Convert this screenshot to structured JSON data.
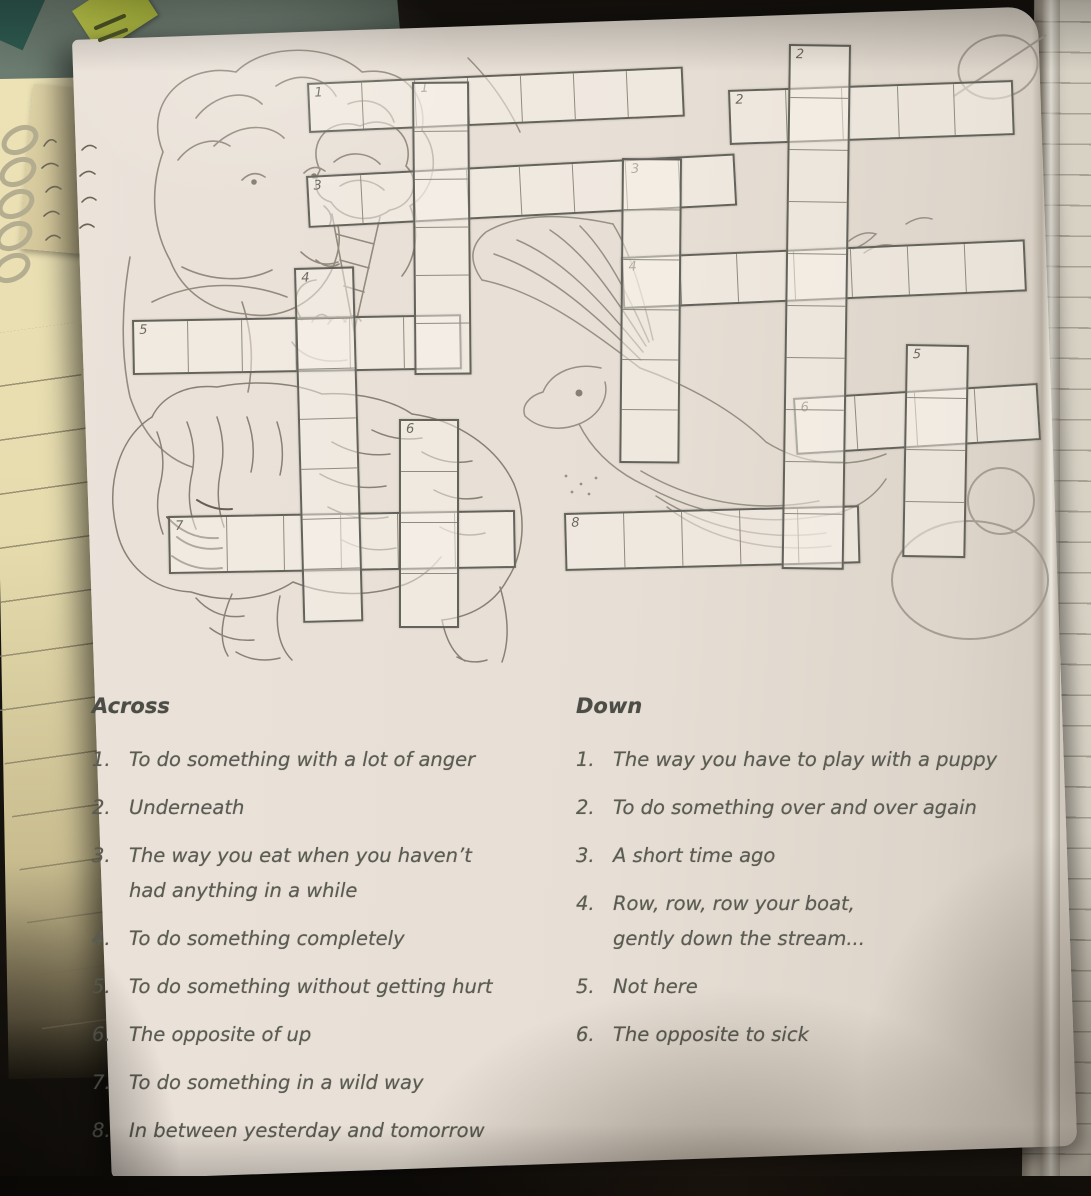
{
  "worksheet": {
    "across": {
      "title": "Across",
      "clues": [
        {
          "num": "1.",
          "lines": [
            "To do something with a lot of anger"
          ]
        },
        {
          "num": "2.",
          "lines": [
            "Underneath"
          ]
        },
        {
          "num": "3.",
          "lines": [
            "The way you eat when you haven’t",
            "had anything in a while"
          ]
        },
        {
          "num": "4.",
          "lines": [
            "To do something completely"
          ]
        },
        {
          "num": "5.",
          "lines": [
            "To do something without getting hurt"
          ]
        },
        {
          "num": "6.",
          "lines": [
            "The opposite of up"
          ]
        },
        {
          "num": "7.",
          "lines": [
            "To do something in a wild way"
          ]
        },
        {
          "num": "8.",
          "lines": [
            "In between yesterday and tomorrow"
          ]
        }
      ]
    },
    "down": {
      "title": "Down",
      "clues": [
        {
          "num": "1.",
          "lines": [
            "The way you have to play with a puppy"
          ]
        },
        {
          "num": "2.",
          "lines": [
            "To do something over and over again"
          ]
        },
        {
          "num": "3.",
          "lines": [
            "A short time ago"
          ]
        },
        {
          "num": "4.",
          "lines": [
            "Row, row, row your boat,",
            "gently down the stream..."
          ]
        },
        {
          "num": "5.",
          "lines": [
            "Not here"
          ]
        },
        {
          "num": "6.",
          "lines": [
            "The opposite to sick"
          ]
        }
      ]
    }
  },
  "grid": {
    "colors": {
      "cell_fill": "rgba(247,242,233,0.5)",
      "outer_border": "#64635b",
      "inner_border": "#8e8b80",
      "number_color": "#6b6a60"
    },
    "runs": [
      {
        "name": "across-1",
        "dir": "h",
        "x": 307,
        "y": 83,
        "len": 7,
        "cw": 53,
        "ch": 45,
        "rot": -2.5,
        "nums": {
          "1": "1",
          "3": "1"
        }
      },
      {
        "name": "across-2",
        "dir": "h",
        "x": 728,
        "y": 90,
        "len": 5,
        "cw": 56,
        "ch": 50,
        "rot": -2,
        "nums": {
          "1": "2"
        }
      },
      {
        "name": "across-3",
        "dir": "h",
        "x": 306,
        "y": 176,
        "len": 8,
        "cw": 53,
        "ch": 47,
        "rot": -3,
        "nums": {
          "1": "3",
          "7": "3"
        }
      },
      {
        "name": "across-4",
        "dir": "h",
        "x": 621,
        "y": 257,
        "len": 7,
        "cw": 57,
        "ch": 47,
        "rot": -2.5,
        "nums": {
          "1": "4"
        }
      },
      {
        "name": "across-5",
        "dir": "h",
        "x": 132,
        "y": 320,
        "len": 6,
        "cw": 54,
        "ch": 50,
        "rot": -1,
        "nums": {
          "1": "5"
        }
      },
      {
        "name": "across-6",
        "dir": "h",
        "x": 793,
        "y": 398,
        "len": 4,
        "cw": 60,
        "ch": 52,
        "rot": -3.5,
        "nums": {
          "1": "6"
        }
      },
      {
        "name": "across-7",
        "dir": "h",
        "x": 168,
        "y": 516,
        "len": 6,
        "cw": 57,
        "ch": 53,
        "rot": -1,
        "nums": {
          "1": "7"
        }
      },
      {
        "name": "across-8",
        "dir": "h",
        "x": 564,
        "y": 513,
        "len": 5,
        "cw": 58,
        "ch": 53,
        "rot": -1.5,
        "nums": {
          "1": "8"
        }
      },
      {
        "name": "down-1",
        "dir": "v",
        "x": 412,
        "y": 82,
        "len": 6,
        "cw": 52,
        "ch": 48,
        "rot": -0.5,
        "nums": {}
      },
      {
        "name": "down-2",
        "dir": "v",
        "x": 789,
        "y": 44,
        "len": 10,
        "cw": 57,
        "ch": 52,
        "rot": 0.8,
        "nums": {
          "1": "2"
        }
      },
      {
        "name": "down-3",
        "dir": "v",
        "x": 622,
        "y": 158,
        "len": 6,
        "cw": 55,
        "ch": 50,
        "rot": 0.5,
        "nums": {}
      },
      {
        "name": "down-4",
        "dir": "v",
        "x": 294,
        "y": 268,
        "len": 7,
        "cw": 55,
        "ch": 50,
        "rot": -1.5,
        "nums": {
          "1": "4"
        }
      },
      {
        "name": "down-5",
        "dir": "v",
        "x": 906,
        "y": 344,
        "len": 4,
        "cw": 58,
        "ch": 52,
        "rot": 1,
        "nums": {
          "1": "5"
        }
      },
      {
        "name": "down-6",
        "dir": "v",
        "x": 399,
        "y": 419,
        "len": 4,
        "cw": 55,
        "ch": 51,
        "rot": 0,
        "nums": {
          "1": "6"
        }
      }
    ]
  },
  "scene": {
    "paper_color": "#e8e0d6",
    "ink_color": "#5a5b53",
    "pad_color": "#e9dfb2",
    "sticky_green": "#2e5c52",
    "flag_yellow": "#c3cf49"
  }
}
